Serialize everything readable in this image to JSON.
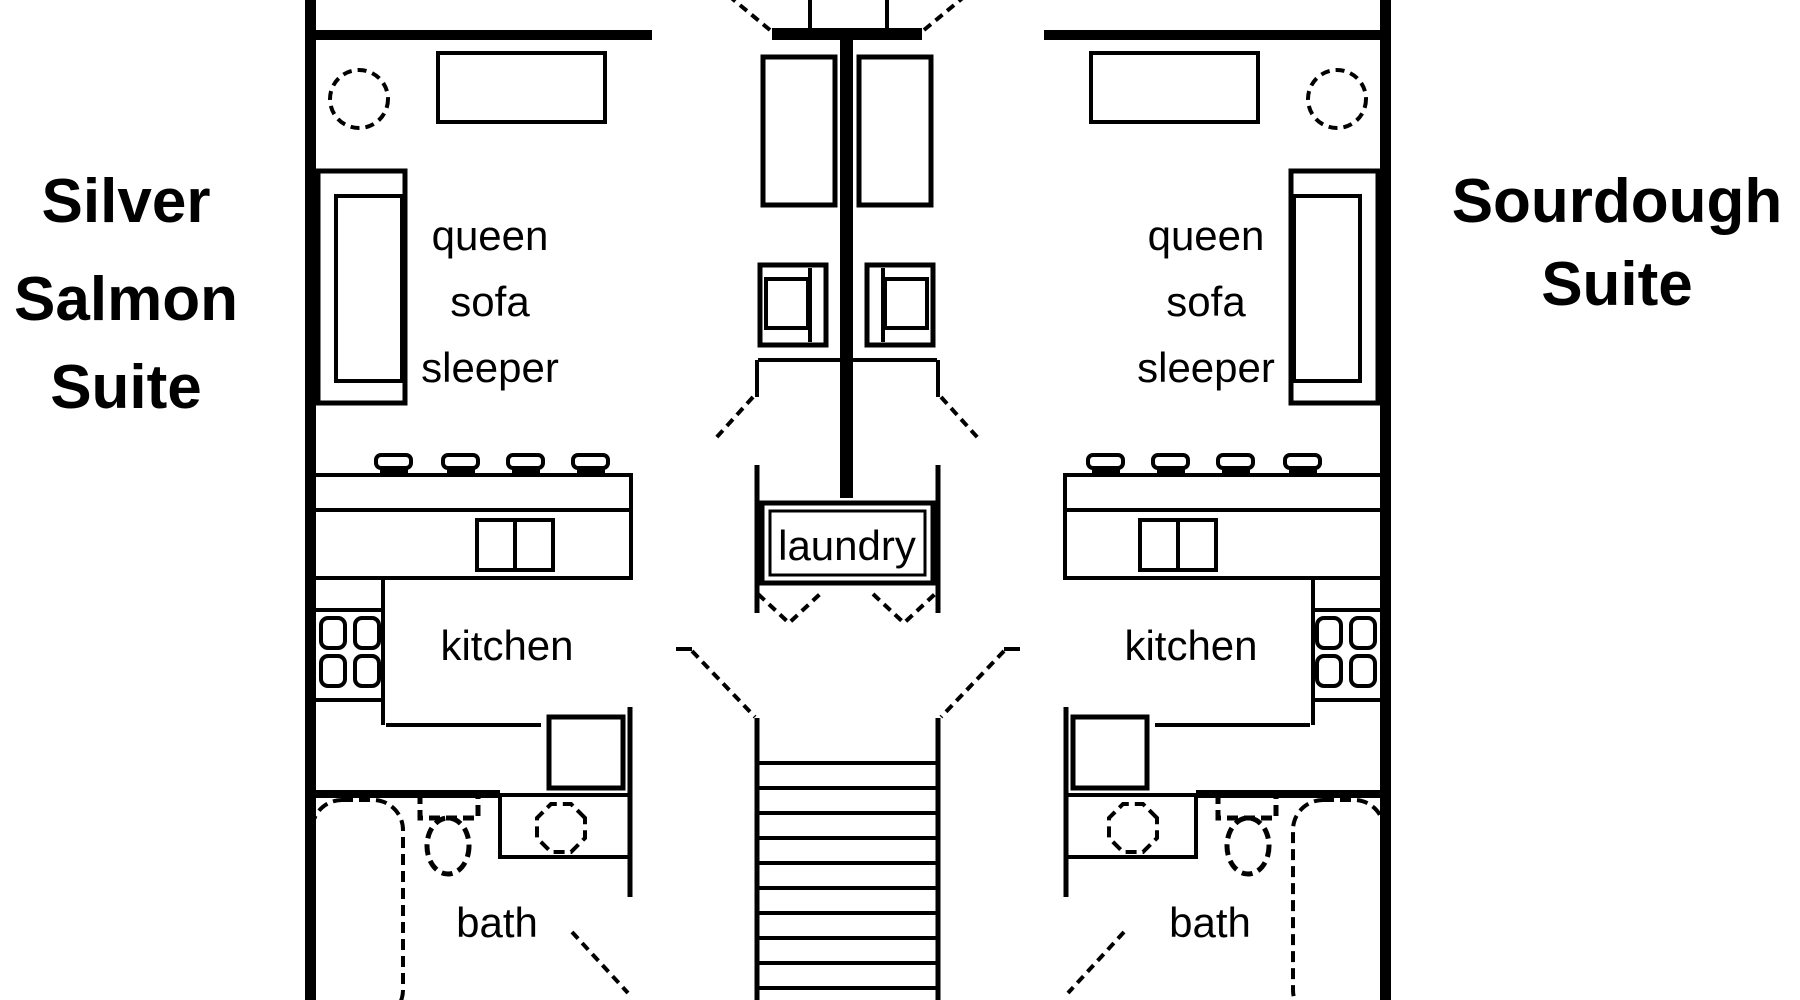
{
  "colors": {
    "ink": "#000000",
    "paper": "#ffffff"
  },
  "left_suite": {
    "title_lines": [
      "Silver",
      "Salmon",
      "Suite"
    ],
    "sofa_label_lines": [
      "queen",
      "sofa",
      "sleeper"
    ],
    "kitchen_label": "kitchen",
    "bath_label": "bath"
  },
  "right_suite": {
    "title_lines": [
      "Sourdough",
      "Suite"
    ],
    "sofa_label_lines": [
      "queen",
      "sofa",
      "sleeper"
    ],
    "kitchen_label": "kitchen",
    "bath_label": "bath"
  },
  "shared": {
    "laundry_label": "laundry"
  }
}
